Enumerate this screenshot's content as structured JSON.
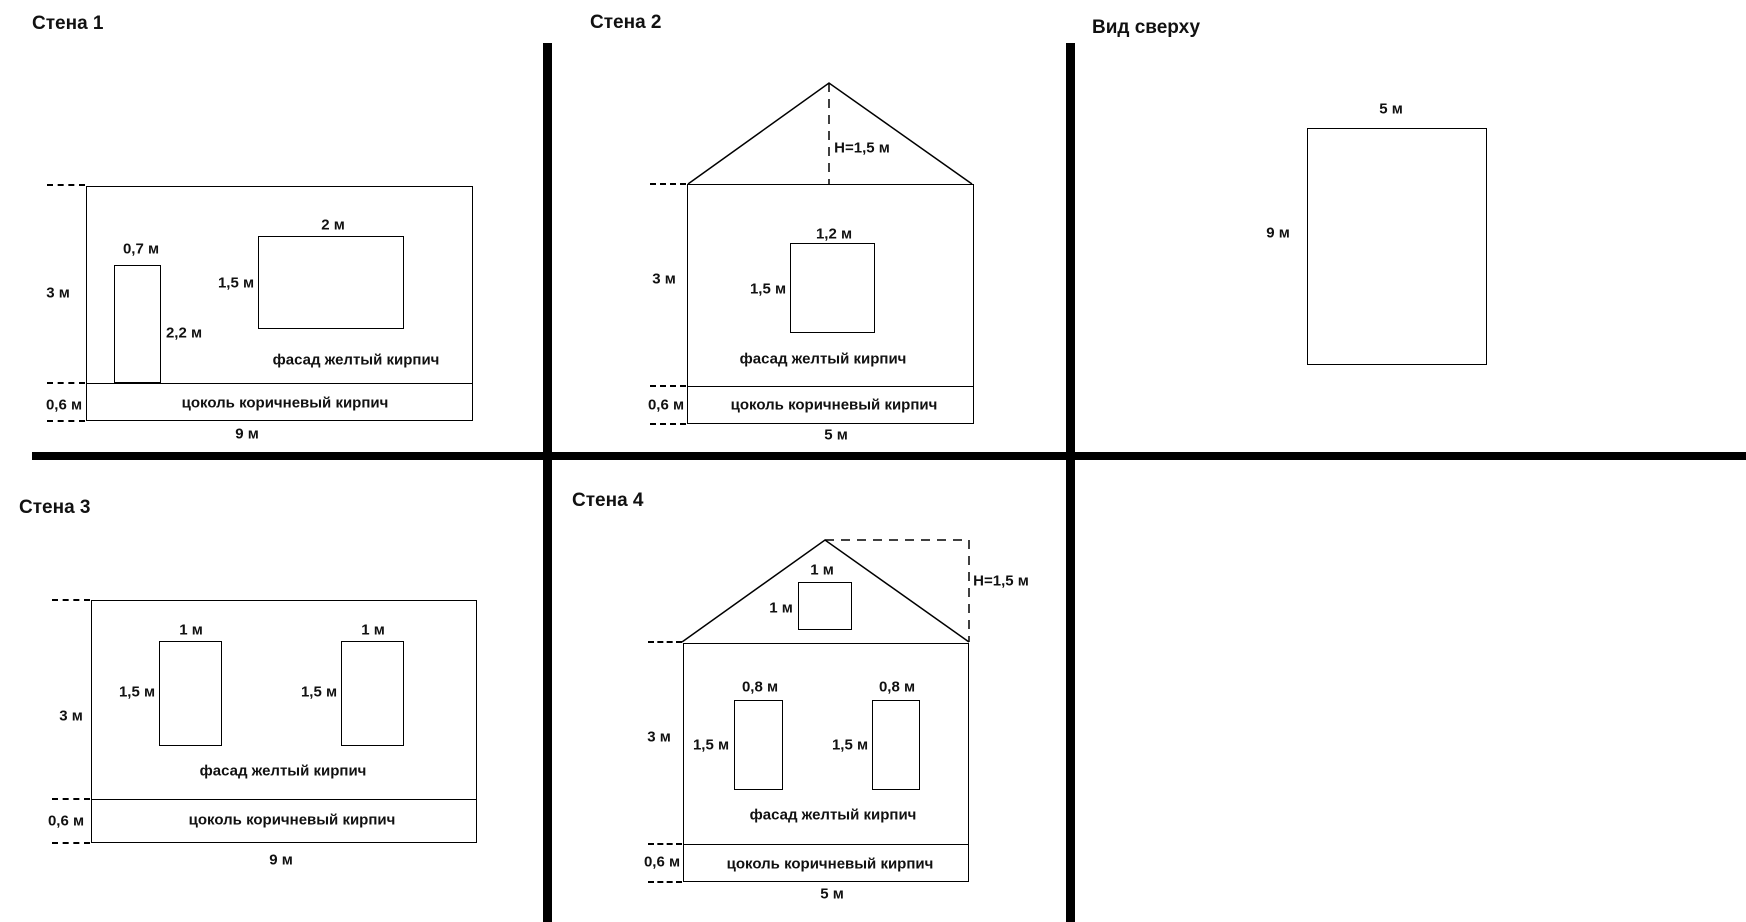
{
  "colors": {
    "line": "#000000",
    "text": "#111111",
    "background": "#ffffff"
  },
  "panels": {
    "wall1": {
      "title": "Стена 1",
      "wall_height": "3 м",
      "wall_width": "9 м",
      "plinth_height": "0,6 м",
      "facade_caption": "фасад желтый кирпич",
      "plinth_caption": "цоколь коричневый кирпич",
      "door_width": "0,7 м",
      "door_height": "2,2 м",
      "window_width": "2 м",
      "window_height": "1,5 м"
    },
    "wall2": {
      "title": "Стена 2",
      "roof_height": "H=1,5 м",
      "wall_height": "3 м",
      "wall_width": "5 м",
      "plinth_height": "0,6 м",
      "facade_caption": "фасад желтый кирпич",
      "plinth_caption": "цоколь коричневый кирпич",
      "window_width": "1,2 м",
      "window_height": "1,5 м"
    },
    "top_view": {
      "title": "Вид сверху",
      "width": "5 м",
      "depth": "9 м"
    },
    "wall3": {
      "title": "Стена 3",
      "wall_height": "3 м",
      "wall_width": "9 м",
      "plinth_height": "0,6 м",
      "facade_caption": "фасад желтый кирпич",
      "plinth_caption": "цоколь коричневый кирпич",
      "window_left_width": "1 м",
      "window_left_height": "1,5 м",
      "window_right_width": "1 м",
      "window_right_height": "1,5 м"
    },
    "wall4": {
      "title": "Стена 4",
      "roof_height": "H=1,5 м",
      "gable_window_width": "1 м",
      "gable_window_height": "1 м",
      "wall_height": "3 м",
      "wall_width": "5 м",
      "plinth_height": "0,6 м",
      "facade_caption": "фасад желтый кирпич",
      "plinth_caption": "цоколь коричневый кирпич",
      "window_left_width": "0,8 м",
      "window_left_height": "1,5 м",
      "window_right_width": "0,8 м",
      "window_right_height": "1,5 м"
    }
  }
}
